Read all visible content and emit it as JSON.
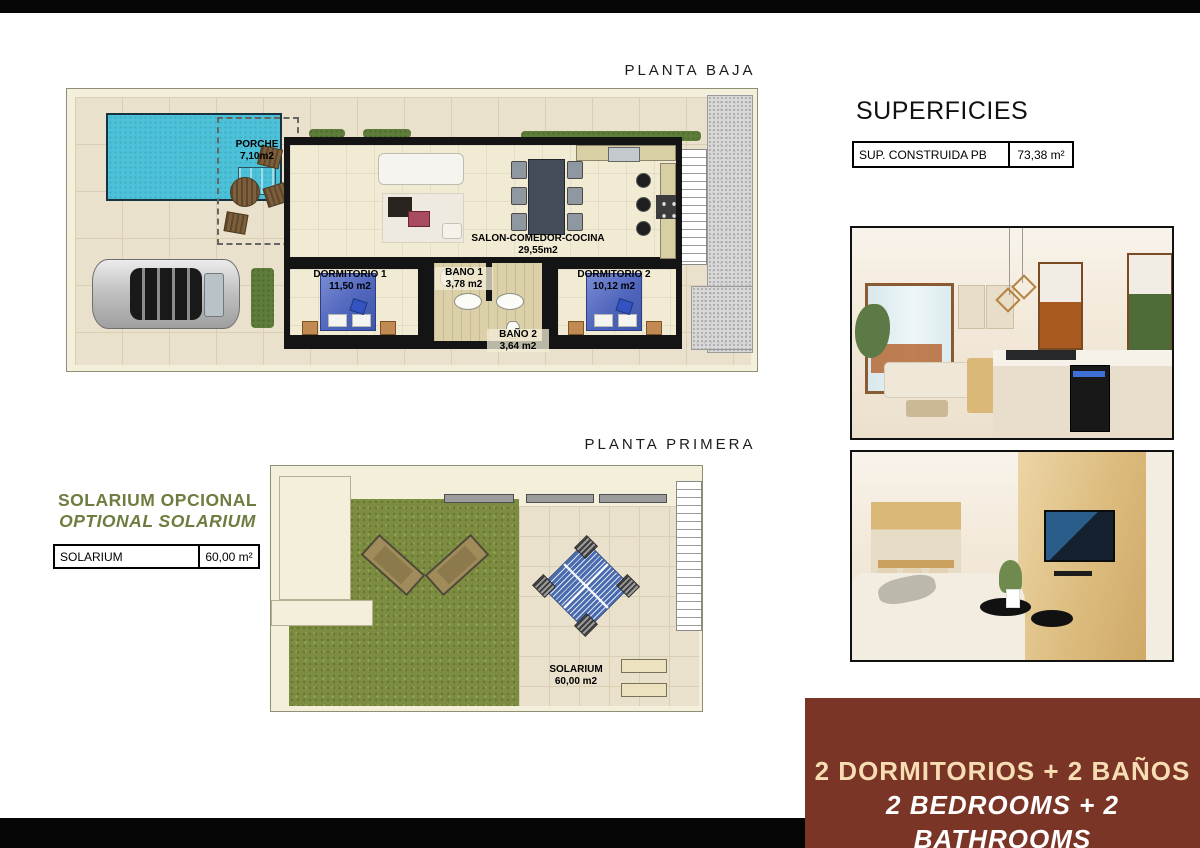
{
  "ground_floor": {
    "title": "PLANTA BAJA",
    "rooms": {
      "porche": {
        "label": "PORCHE",
        "area": "7,10m2"
      },
      "salon": {
        "label": "SALON-COMEDOR-COCINA",
        "area": "29,55m2"
      },
      "dormitorio1": {
        "label": "DORMITORIO 1",
        "area": "11,50 m2"
      },
      "bano1": {
        "label": "BANO 1",
        "area": "3,78 m2"
      },
      "bano2": {
        "label": "BAÑO 2",
        "area": "3,64 m2"
      },
      "dormitorio2": {
        "label": "DORMITORIO 2",
        "area": "10,12 m2"
      }
    }
  },
  "first_floor": {
    "title": "PLANTA PRIMERA",
    "rooms": {
      "solarium": {
        "label": "SOLARIUM",
        "area": "60,00 m2"
      }
    }
  },
  "superficies": {
    "title": "SUPERFICIES",
    "rows": [
      {
        "label": "SUP. CONSTRUIDA PB",
        "value": "73,38  m²"
      }
    ]
  },
  "solarium_option": {
    "line1": "SOLARIUM OPCIONAL",
    "line2": "OPTIONAL SOLARIUM",
    "table": {
      "label": "SOLARIUM",
      "value": "60,00  m²"
    }
  },
  "footer_banner": {
    "line1": "2 DORMITORIOS + 2 BAÑOS",
    "line2": "2 BEDROOMS + 2 BATHROOMS"
  },
  "photos": {
    "photo1_alt": "interior living room and kitchen",
    "photo2_alt": "interior living room with TV wall"
  },
  "colors": {
    "banner_bg": "#7a3526",
    "banner_text1": "#f7ddb3",
    "banner_text2": "#ffffff",
    "olive_text": "#6d7d3f",
    "pool": "#4cc1d7",
    "grass": "#7c8d41"
  }
}
